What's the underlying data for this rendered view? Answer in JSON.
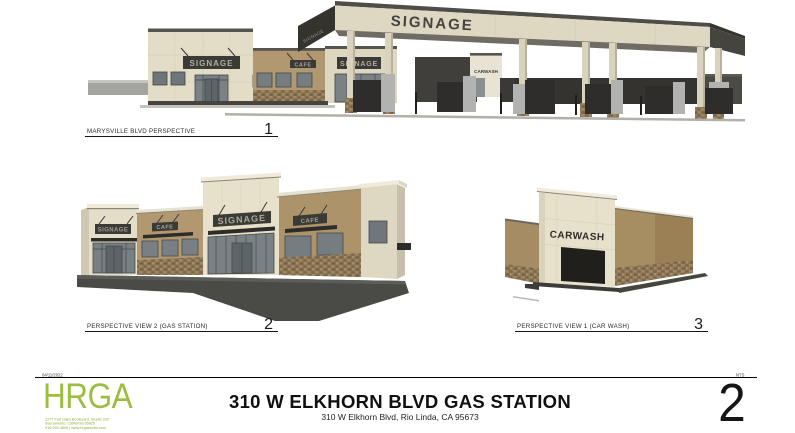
{
  "colors": {
    "accent_green": "#9cbe3e",
    "cream_wall": "#e4dec9",
    "tan_wall": "#b09770",
    "stone": "#8a7456",
    "dark_trim": "#3a3a36",
    "glass": "#7b8286",
    "pavement": "#4a4a47"
  },
  "views": {
    "top": {
      "label": "MARYSVILLE BLVD PERSPECTIVE",
      "number": "1",
      "canopy_sign": "SIGNAGE",
      "canopy_side_sign": "SIGNAGE",
      "building_sign": "SIGNAGE",
      "building_sign2": "SIGNAGE",
      "cafe_sign": "CAFE",
      "carwash_sign": "CARWASH"
    },
    "gas_station": {
      "label": "PERSPECTIVE VIEW 2 (GAS STATION)",
      "number": "2",
      "signs": [
        "SIGNAGE",
        "CAFE",
        "SIGNAGE",
        "CAFE"
      ]
    },
    "car_wash": {
      "label": "PERSPECTIVE VIEW 1 (CAR WASH)",
      "number": "3",
      "sign": "CARWASH"
    }
  },
  "footer": {
    "date": "04/11/2022",
    "right_note": "NTS",
    "logo": "HRGA",
    "address_line1": "2277 Fair Oaks Boulevard, Studio 220",
    "address_line2": "Sacramento, California 95825",
    "address_line3": "916.993.4805 | www.hrgastudio.com",
    "title": "310 W ELKHORN BLVD GAS STATION",
    "subtitle": "310 W Elkhorn Blvd, Rio Linda, CA 95673",
    "sheet_number": "2"
  }
}
